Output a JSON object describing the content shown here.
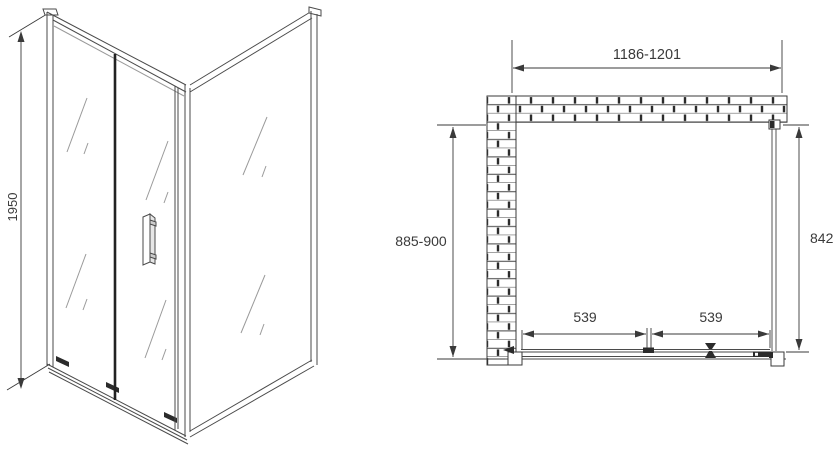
{
  "page": {
    "background": "#ffffff",
    "line_color": "#3a3a3a",
    "glass_line_color": "#999999",
    "joint_color": "#2b2b2b"
  },
  "front_view": {
    "dimensions": {
      "height": "1950"
    }
  },
  "plan_view": {
    "dimensions": {
      "overall_width": "1186-1201",
      "side_depth": "885-900",
      "side_glass": "842",
      "door_panel_left": "539",
      "door_panel_right": "539"
    }
  }
}
